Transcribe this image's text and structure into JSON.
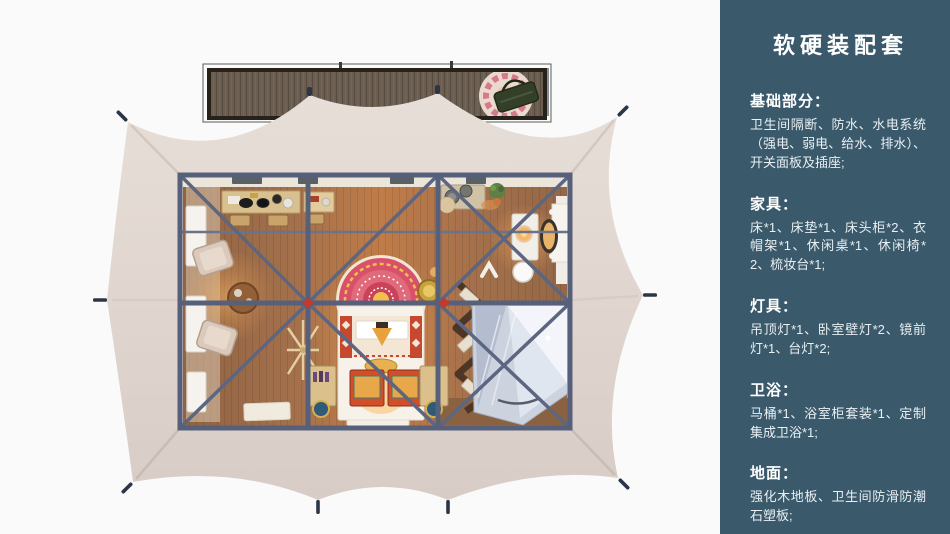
{
  "panel": {
    "title": "软硬装配套",
    "sections": [
      {
        "heading": "基础部分：",
        "body": "卫生间隔断、防水、水电系统（强电、弱电、给水、排水）、开关面板及插座;"
      },
      {
        "heading": "家具：",
        "body": "床*1、床垫*1、床头柜*2、衣帽架*1、休闲桌*1、休闲椅*2、梳妆台*1;"
      },
      {
        "heading": "灯具：",
        "body": "吊顶灯*1、卧室壁灯*2、镜前灯*1、台灯*2;"
      },
      {
        "heading": "卫浴：",
        "body": "马桶*1、浴室柜套装*1、定制集成卫浴*1;"
      },
      {
        "heading": "地面：",
        "body": "强化木地板、卫生间防滑防潮石塑板;"
      }
    ]
  },
  "colors": {
    "page-bg": "#fafafa",
    "panel-bg": "#3a5a6c",
    "panel-text": "#ffffff",
    "panel-body-text": "#e9eff2",
    "canopy": "#e2d8d1",
    "canopy-shade": "#d7cbc4",
    "frame": "#57607a",
    "accent-red": "#c03a2e",
    "floor-wood": "#a5714c",
    "deck-wood": "#6b5e50",
    "deck-frame": "#262219",
    "glass": "#ccd3df"
  }
}
